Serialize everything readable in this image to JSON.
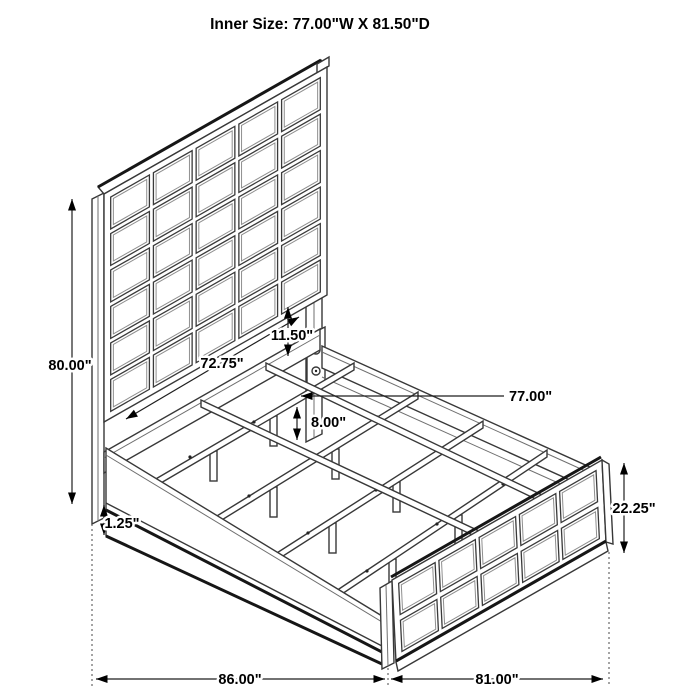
{
  "title": "Inner Size: 77.00\"W X 81.50\"D",
  "diagram": {
    "subject": "Panel bed frame isometric dimension drawing",
    "style": {
      "background": "#ffffff",
      "line_color": "#383838",
      "accent_line_color": "#161616",
      "dimension_color": "#000000"
    },
    "headboard": {
      "grid_cols": 5,
      "grid_rows": 6
    },
    "footboard": {
      "grid_cols": 5,
      "grid_rows": 2
    },
    "slats": {
      "count": 4,
      "legs_per_slat": 2
    },
    "dimensions": {
      "overall_height": "80.00\"",
      "headboard_width": "72.75\"",
      "headboard_rail_gap": "11.50\"",
      "inner_width": "77.00\"",
      "slat_leg_height": "8.00\"",
      "rail_bottom_thickness": "1.25\"",
      "footboard_height": "22.25\"",
      "side_rail_length": "86.00\"",
      "footboard_width": "81.00\""
    }
  }
}
